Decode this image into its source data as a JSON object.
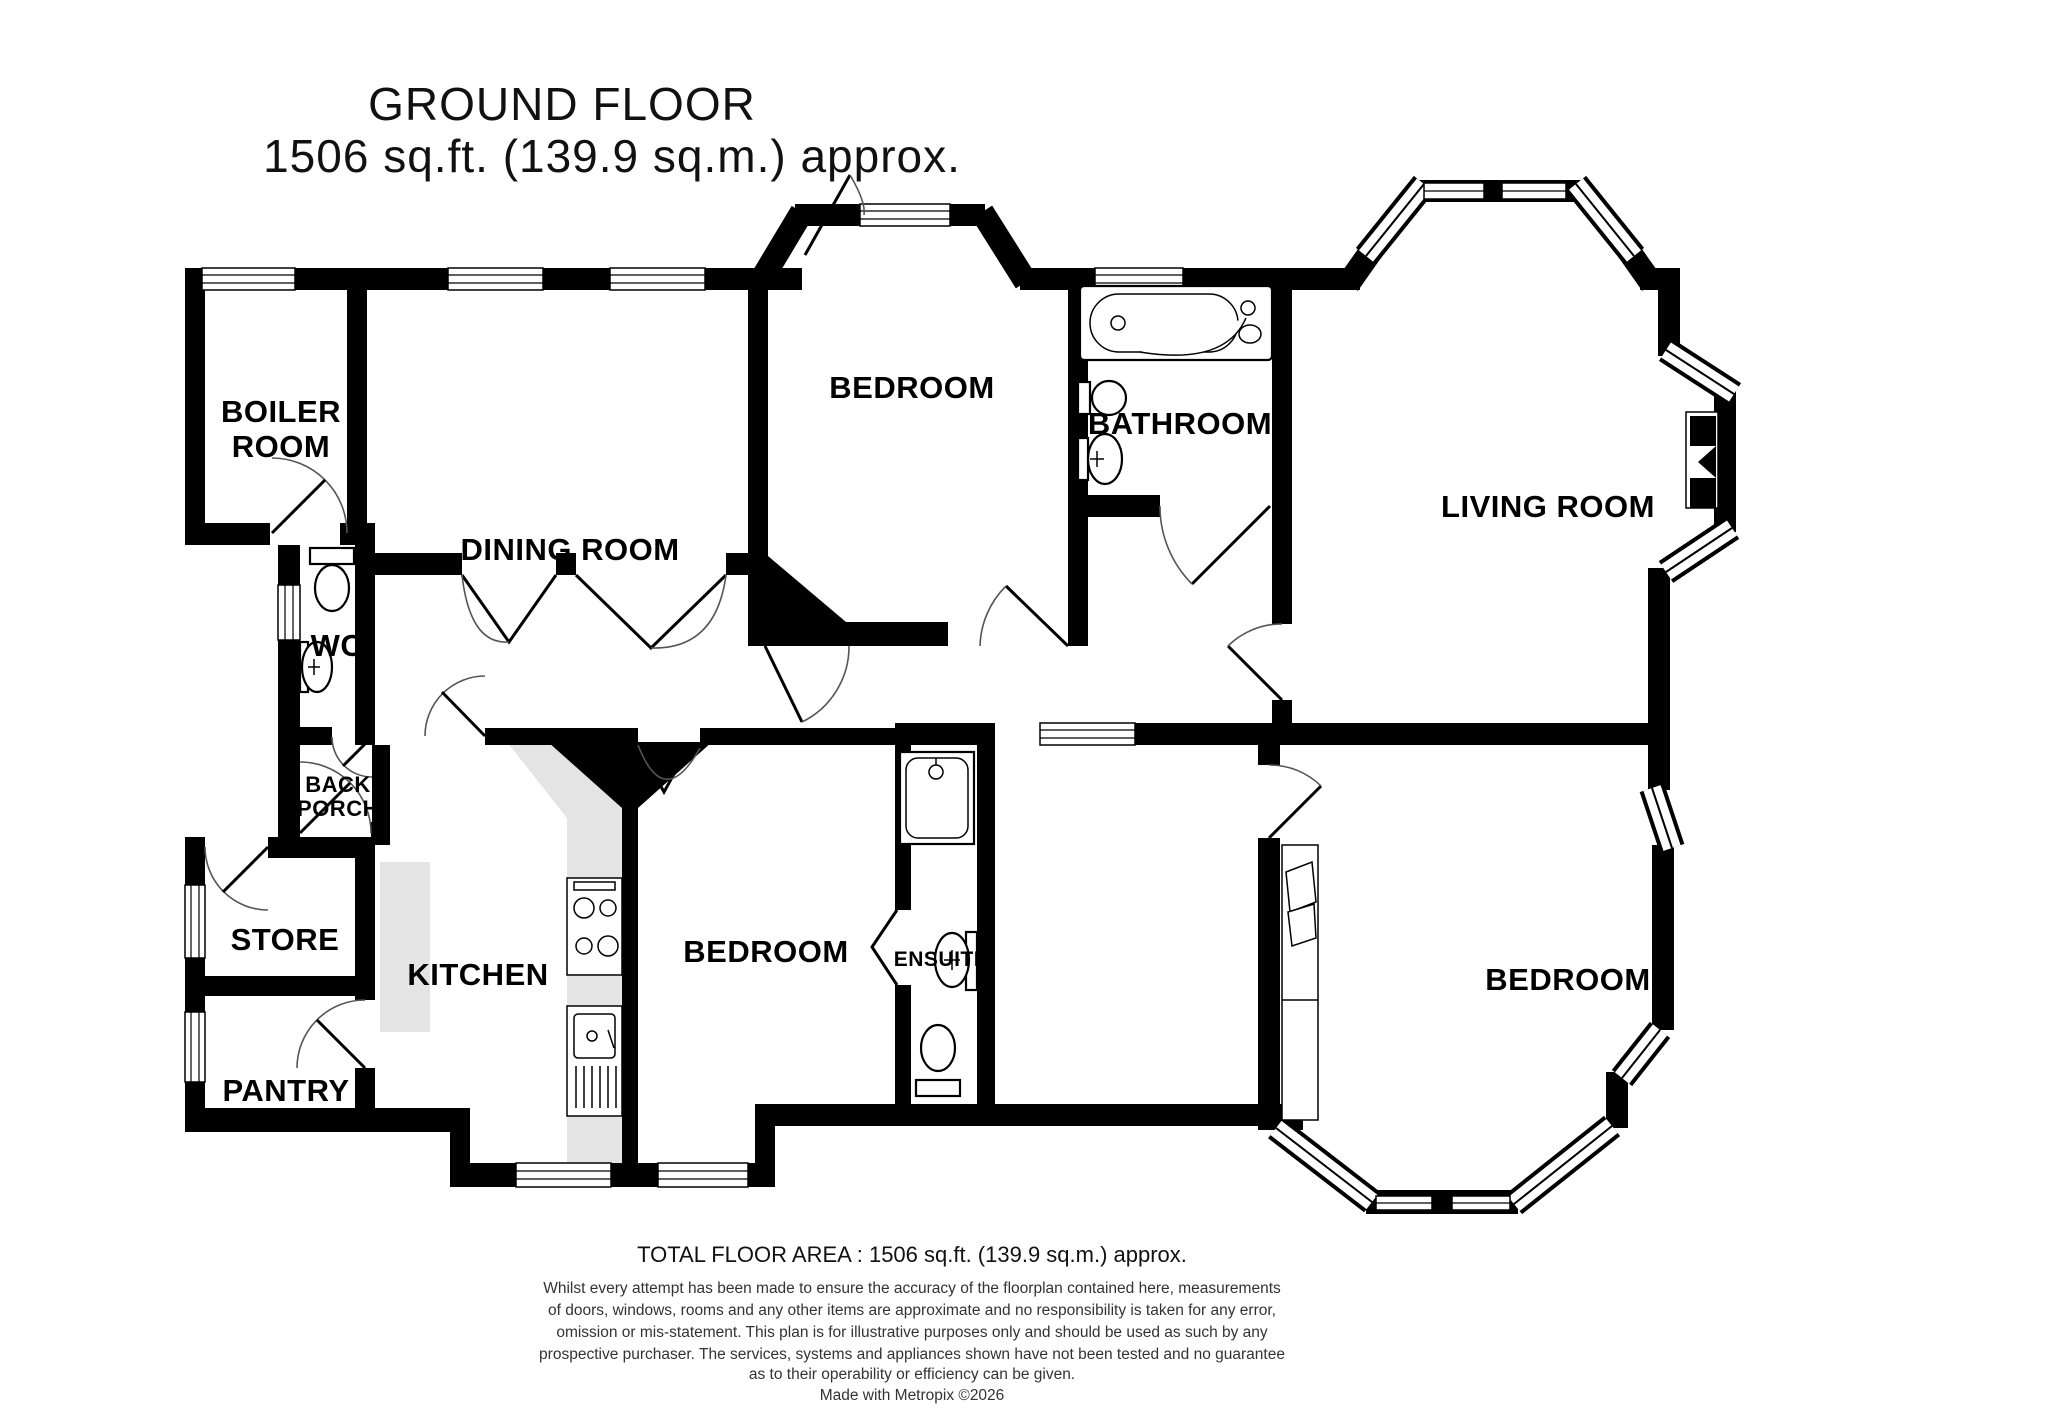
{
  "title": {
    "line1": "GROUND FLOOR",
    "line2": "1506 sq.ft. (139.9 sq.m.) approx."
  },
  "rooms": {
    "boiler_room": {
      "line1": "BOILER",
      "line2": "ROOM"
    },
    "dining_room": {
      "label": "DINING ROOM"
    },
    "bedroom_top": {
      "label": "BEDROOM"
    },
    "bathroom": {
      "label": "BATHROOM"
    },
    "living_room": {
      "label": "LIVING ROOM"
    },
    "wc": {
      "label": "WC"
    },
    "back_porch": {
      "line1": "BACK",
      "line2": "PORCH"
    },
    "store": {
      "label": "STORE"
    },
    "kitchen": {
      "label": "KITCHEN"
    },
    "bedroom_middle": {
      "label": "BEDROOM"
    },
    "ensuite": {
      "label": "ENSUITE"
    },
    "pantry": {
      "label": "PANTRY"
    },
    "bedroom_right": {
      "label": "BEDROOM"
    }
  },
  "footer": {
    "total_area": "TOTAL FLOOR AREA : 1506 sq.ft. (139.9 sq.m.) approx.",
    "disclaimer_lines": [
      "Whilst every attempt has been made to ensure the accuracy of the floorplan contained here, measurements",
      "of doors, windows, rooms and any other items are approximate and no responsibility is taken for any error,",
      "omission or mis-statement. This plan is for illustrative purposes only and should be used as such by any",
      "prospective purchaser. The services, systems and appliances shown have not been tested and no guarantee",
      "as to their operability or efficiency can be given.",
      "Made with Metropix ©2026"
    ]
  },
  "colors": {
    "wall": "#000000",
    "counter": "#e4e4e4",
    "background": "#ffffff"
  }
}
